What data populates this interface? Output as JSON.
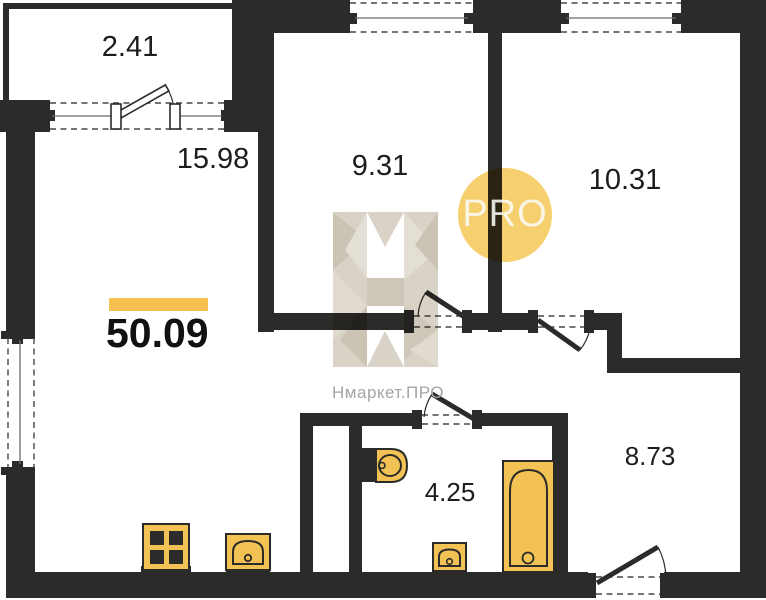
{
  "plan": {
    "type": "apartment-floor-plan",
    "total_area": "50.09",
    "rooms": [
      {
        "name": "balcony",
        "area_label": "2.41"
      },
      {
        "name": "living-kitchen",
        "area_label": "15.98"
      },
      {
        "name": "room-1",
        "area_label": "9.31"
      },
      {
        "name": "room-2",
        "area_label": "10.31"
      },
      {
        "name": "bathroom",
        "area_label": "4.25"
      },
      {
        "name": "hallway",
        "area_label": "8.73"
      }
    ],
    "watermark": {
      "brand_text": "Нмаркет.ПРО",
      "badge_text": "PRO",
      "logo_letter": "Н"
    },
    "colors": {
      "wall": "#2b2b29",
      "fixture_fill": "#f3c254",
      "accent_bar": "#f5c251",
      "badge_circle": "#f6d06e",
      "watermark_beige": "#d9d2c6",
      "brand_text_gray": "#a5a5a3"
    }
  }
}
